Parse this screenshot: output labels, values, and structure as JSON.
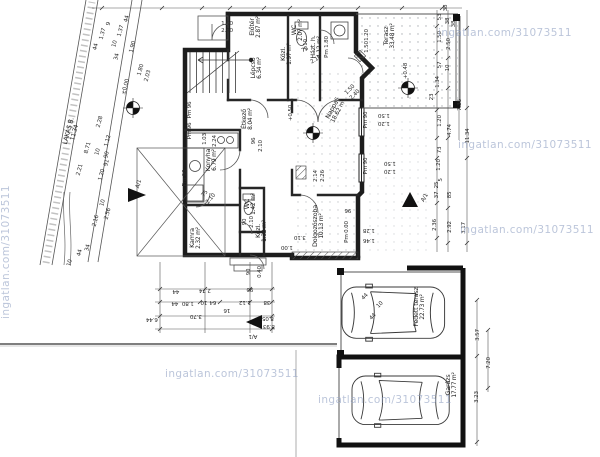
{
  "meta": {
    "watermark": "ingatlan.com/31073511",
    "drawing_type": "földszinti alaprajz / ground floor plan"
  },
  "rooms": [
    {
      "t": "Előtér",
      "a": "2.87 m²",
      "x": 256,
      "y": 27,
      "r": -90
    },
    {
      "t": "WC",
      "a": "2.07 m²",
      "x": 298,
      "y": 30,
      "r": -90
    },
    {
      "t": "Közl.",
      "a": "1.97 m²",
      "x": 287,
      "y": 54,
      "r": -90
    },
    {
      "t": "Házt. h.",
      "a": "4.12 m²",
      "x": 317,
      "y": 47,
      "r": -90
    },
    {
      "t": "Terasz",
      "a": "33.48 m²",
      "x": 390,
      "y": 36,
      "r": -90
    },
    {
      "t": "Lépcső",
      "a": "6.34 m²",
      "x": 257,
      "y": 68,
      "r": -90
    },
    {
      "t": "Étkező",
      "a": "8.04 m²",
      "x": 248,
      "y": 119,
      "r": -90
    },
    {
      "t": "Konyha",
      "a": "6.79 m²",
      "x": 212,
      "y": 160,
      "r": -90
    },
    {
      "t": "Nappali",
      "a": "18.62 m²",
      "x": 336,
      "y": 110,
      "r": -62
    },
    {
      "t": "WC",
      "a": "1.42 m²",
      "x": 251,
      "y": 204,
      "r": -90
    },
    {
      "t": "Kamra",
      "a": "2.32 m²",
      "x": 196,
      "y": 238,
      "r": -90
    },
    {
      "t": "Közl.",
      "a": "1.32 m²",
      "x": 262,
      "y": 231,
      "r": -90
    },
    {
      "t": "Dolgozószoba",
      "a": "10.13 m²",
      "x": 319,
      "y": 226,
      "r": -90
    },
    {
      "t": "Fedett terasz",
      "a": "22.73 m²",
      "x": 420,
      "y": 307,
      "r": -90
    },
    {
      "t": "Garázs",
      "a": "17.77 m²",
      "x": 452,
      "y": 385,
      "r": -90
    },
    {
      "t": "LAKÁS B.",
      "a": "11.34",
      "x": 72,
      "y": 132,
      "r": -75
    }
  ],
  "dims": [
    [
      "44",
      96,
      47,
      -75
    ],
    [
      "1.37",
      103,
      34,
      -75
    ],
    [
      "9",
      109,
      24,
      -75
    ],
    [
      "10",
      115,
      44,
      -75
    ],
    [
      "1.37",
      121,
      31,
      -75
    ],
    [
      "44",
      127,
      19,
      -75
    ],
    [
      "34",
      117,
      57,
      -75
    ],
    [
      "1.90",
      133,
      47,
      -75
    ],
    [
      "1.80",
      141,
      70,
      -75
    ],
    [
      "2.03",
      148,
      76,
      -75
    ],
    [
      "8.71",
      88,
      148,
      -75
    ],
    [
      "2.28",
      100,
      122,
      -75
    ],
    [
      "1.12",
      108,
      141,
      -75
    ],
    [
      "10",
      98,
      152,
      -75
    ],
    [
      "90",
      107,
      155,
      -75
    ],
    [
      "91",
      107,
      163,
      -75
    ],
    [
      "1.20",
      102,
      175,
      -75
    ],
    [
      "2.21",
      80,
      170,
      -75
    ],
    [
      "±0.00",
      126,
      87,
      -75
    ],
    [
      "10",
      103,
      203,
      -75
    ],
    [
      "2.56",
      108,
      214,
      -75
    ],
    [
      "2.16",
      96,
      221,
      -75
    ],
    [
      "34",
      88,
      248,
      -75
    ],
    [
      "44",
      80,
      253,
      -75
    ],
    [
      "10",
      70,
      263,
      -75
    ],
    [
      "1.90",
      227,
      24,
      0
    ],
    [
      "2.40",
      227,
      31,
      0
    ],
    [
      "2.10",
      306,
      45,
      -90
    ],
    [
      "75",
      305,
      50,
      -30
    ],
    [
      "2.10",
      316,
      60,
      -30
    ],
    [
      "Pm 1.80",
      327,
      47,
      -90
    ],
    [
      "1.20",
      367,
      35,
      -90
    ],
    [
      "1.50",
      367,
      47,
      -90
    ],
    [
      "Pm 96",
      190,
      110,
      -90
    ],
    [
      "Pm 96",
      190,
      131,
      -90
    ],
    [
      "Pm 96",
      185,
      178,
      -90
    ],
    [
      "1.03",
      205,
      139,
      -90
    ],
    [
      "2.24",
      215,
      141,
      -90
    ],
    [
      "96",
      254,
      141,
      -90
    ],
    [
      "2.10",
      261,
      146,
      -90
    ],
    [
      "1.50",
      350,
      90,
      -45
    ],
    [
      "2.40",
      355,
      95,
      -45
    ],
    [
      "+0.50",
      291,
      113,
      -90
    ],
    [
      "Pm 90",
      366,
      120,
      -90
    ],
    [
      "1.50",
      384,
      115,
      180
    ],
    [
      "1.20",
      384,
      123,
      180
    ],
    [
      "Pm 90",
      366,
      166,
      -90
    ],
    [
      "1.50",
      390,
      163,
      180
    ],
    [
      "1.20",
      390,
      171,
      180
    ],
    [
      "2.14",
      316,
      176,
      -90
    ],
    [
      "2.26",
      323,
      176,
      -90
    ],
    [
      "+0.48",
      406,
      71,
      -90
    ],
    [
      "75",
      205,
      194,
      -50
    ],
    [
      "2.10",
      211,
      199,
      -50
    ],
    [
      "90",
      245,
      222,
      -90
    ],
    [
      "2.10",
      252,
      222,
      -90
    ],
    [
      "3.10",
      300,
      237,
      180
    ],
    [
      "1.00",
      287,
      247,
      180
    ],
    [
      "96",
      348,
      210,
      180
    ],
    [
      "1.28",
      369,
      230,
      180
    ],
    [
      "1.46",
      369,
      240,
      180
    ],
    [
      "Pm 0.00",
      347,
      232,
      -90
    ],
    [
      "90",
      249,
      272,
      -90
    ],
    [
      "0.40",
      260,
      272,
      -90
    ],
    [
      "44",
      176,
      291,
      180
    ],
    [
      "2.74",
      205,
      290,
      180
    ],
    [
      "90",
      250,
      289,
      180
    ],
    [
      "44",
      175,
      303,
      180
    ],
    [
      "1.80",
      188,
      303,
      180
    ],
    [
      "10",
      204,
      302,
      180
    ],
    [
      "64",
      213,
      302,
      180
    ],
    [
      "1.12",
      245,
      302,
      180
    ],
    [
      "38",
      267,
      302,
      180
    ],
    [
      "16",
      227,
      310,
      180
    ],
    [
      "3.70",
      196,
      316,
      180
    ],
    [
      "6.44",
      152,
      319,
      180
    ],
    [
      "8.05",
      268,
      318,
      180
    ],
    [
      "8.93",
      269,
      326,
      180
    ],
    [
      "38",
      446,
      8,
      -90
    ],
    [
      "53",
      440,
      17,
      -90
    ],
    [
      "38",
      448,
      21,
      -90
    ],
    [
      "38",
      454,
      24,
      -90
    ],
    [
      "1.50",
      440,
      37,
      -90
    ],
    [
      "2.50",
      449,
      44,
      -90
    ],
    [
      "57",
      440,
      65,
      -90
    ],
    [
      "10",
      448,
      68,
      -90
    ],
    [
      "1.34",
      438,
      82,
      -90
    ],
    [
      "23",
      432,
      97,
      -90
    ],
    [
      "7.36",
      460,
      105,
      -90
    ],
    [
      "1.20",
      440,
      121,
      -90
    ],
    [
      "4.74",
      450,
      130,
      -90
    ],
    [
      "11.34",
      468,
      136,
      -90
    ],
    [
      "73",
      440,
      150,
      -90
    ],
    [
      "1.20",
      439,
      165,
      -90
    ],
    [
      "5",
      441,
      180,
      -90
    ],
    [
      "25",
      437,
      185,
      -90
    ],
    [
      "37",
      437,
      195,
      -90
    ],
    [
      "85",
      450,
      195,
      -90
    ],
    [
      "2.36",
      435,
      225,
      -90
    ],
    [
      "2.92",
      450,
      227,
      -90
    ],
    [
      "3.17",
      464,
      228,
      -90
    ],
    [
      "44",
      365,
      297,
      -45
    ],
    [
      "10",
      380,
      305,
      -45
    ],
    [
      "44",
      373,
      317,
      -45
    ],
    [
      "3.57",
      478,
      335,
      -90
    ],
    [
      "7.20",
      489,
      363,
      -90
    ],
    [
      "3.23",
      477,
      397,
      -90
    ],
    [
      "A/1",
      139,
      184,
      -75
    ],
    [
      "A/1",
      425,
      198,
      -60
    ],
    [
      "A/1",
      253,
      336,
      180
    ]
  ],
  "watermarks": [
    {
      "x": 6,
      "y": 252,
      "r": -90
    },
    {
      "x": 505,
      "y": 33,
      "r": 0
    },
    {
      "x": 525,
      "y": 145,
      "r": 0
    },
    {
      "x": 527,
      "y": 230,
      "r": 0
    },
    {
      "x": 232,
      "y": 374,
      "r": 0
    },
    {
      "x": 385,
      "y": 400,
      "r": 0
    }
  ]
}
